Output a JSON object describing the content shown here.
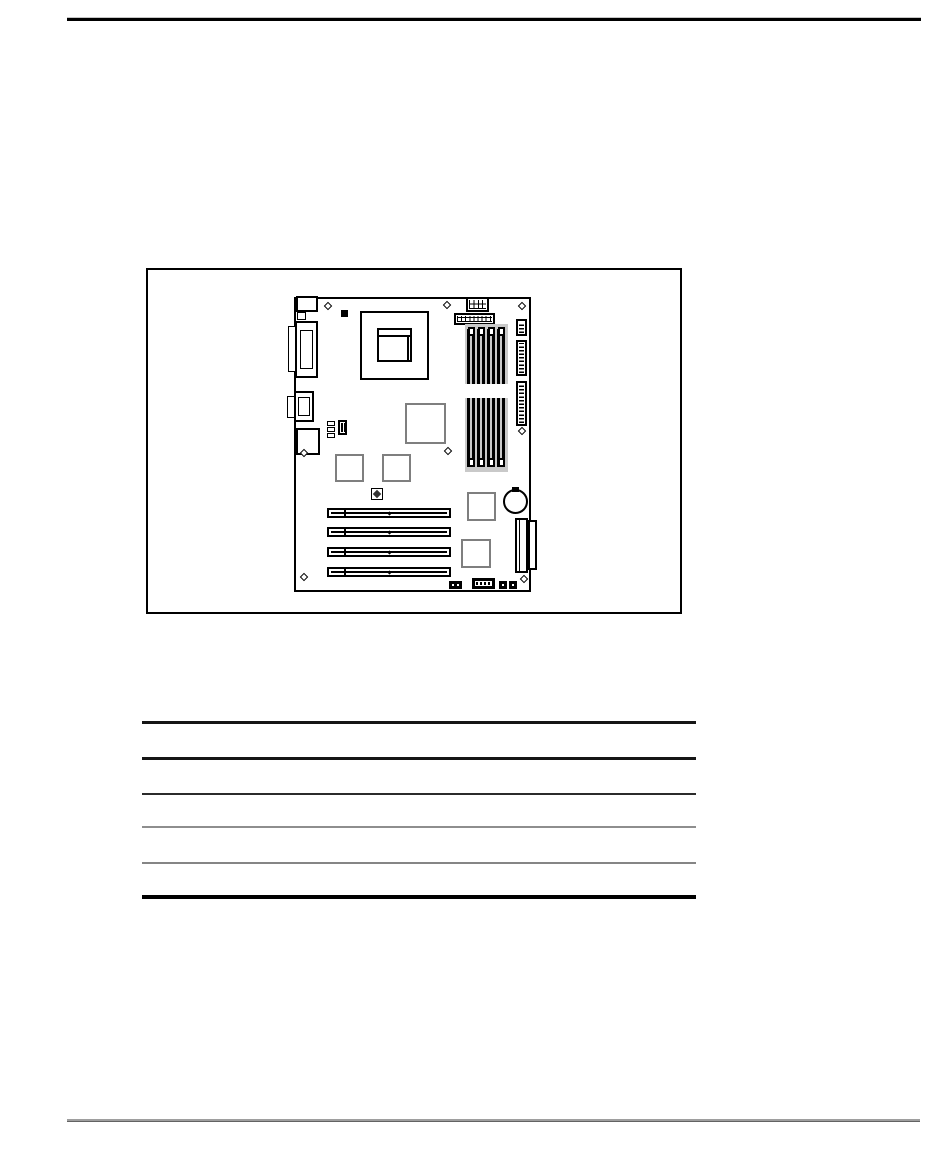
{
  "document": {
    "kind": "printed-manual-page",
    "visible_text": [],
    "colors": {
      "page_background": "#ffffff",
      "line_black": "#000000",
      "line_gray": "#8a8a8a",
      "chip_outline_gray": "#7f7f7f",
      "dimm_shading": "#c9c9c9"
    },
    "header_rule": {
      "present": true
    },
    "footer_rule": {
      "present": true
    },
    "figure": {
      "subject": "motherboard-layout-diagram",
      "components": [
        "keyboard-mouse-connector",
        "parallel-port-connector",
        "serial-port-connector",
        "audio-game-connector",
        "fan-header",
        "cpu-socket",
        "aux-power-connector",
        "main-power-connector",
        "dimm-slot-1",
        "dimm-slot-2",
        "dimm-slot-3",
        "dimm-slot-4",
        "floppy-connector",
        "ide-connector-primary",
        "ide-connector-secondary",
        "north-bridge-chip",
        "chip-square-1",
        "chip-square-2",
        "chip-square-3",
        "chip-square-4",
        "jumper-block-1",
        "jumper-block-2",
        "configuration-jumper",
        "battery",
        "pci-slot-1",
        "pci-slot-2",
        "pci-slot-3",
        "pci-slot-4",
        "riser-edge-connector",
        "front-panel-header-1",
        "front-panel-header-2",
        "front-panel-header-3",
        "mounting-hole-x8"
      ]
    },
    "table": {
      "rule_count": 6,
      "visible_text_rows": []
    }
  }
}
